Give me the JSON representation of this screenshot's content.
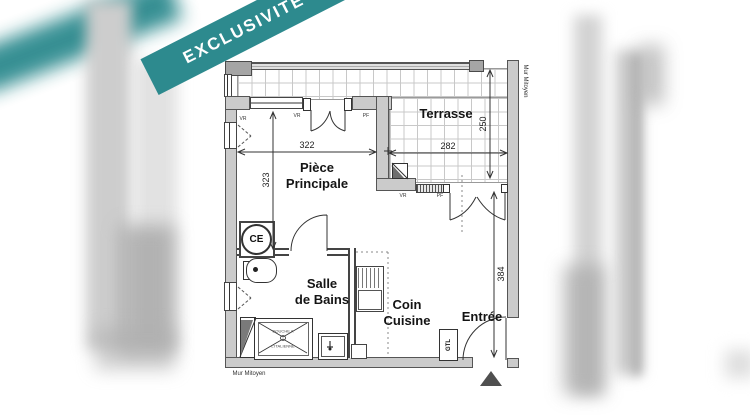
{
  "banner": {
    "text": "EXCLUSIVITÉ",
    "color": "#2d8a8e"
  },
  "plan": {
    "rooms": {
      "terrace": "Terrasse",
      "main_line1": "Pièce",
      "main_line2": "Principale",
      "bath_line1": "Salle",
      "bath_line2": "de Bains",
      "kitchen_line1": "Coin",
      "kitchen_line2": "Cuisine",
      "entry": "Entrée"
    },
    "dimensions": {
      "main_width": "322",
      "terrace_width": "282",
      "terrace_depth": "250",
      "main_depth": "323",
      "entry_depth": "384"
    },
    "fixtures": {
      "water_heater": "CE",
      "technical_duct": "GTL",
      "shower_line1": "DOUCHE A",
      "shower_line2": "L'ITALIENNE"
    },
    "openings": {
      "vr_left": "VR",
      "vr_top": "VR",
      "pf_top": "PF",
      "vr_terrace": "VR",
      "pf_terrace": "PF"
    },
    "walls": {
      "party_wall_right": "Mur Mitoyen",
      "party_wall_bottom": "Mur Mitoyen"
    }
  }
}
